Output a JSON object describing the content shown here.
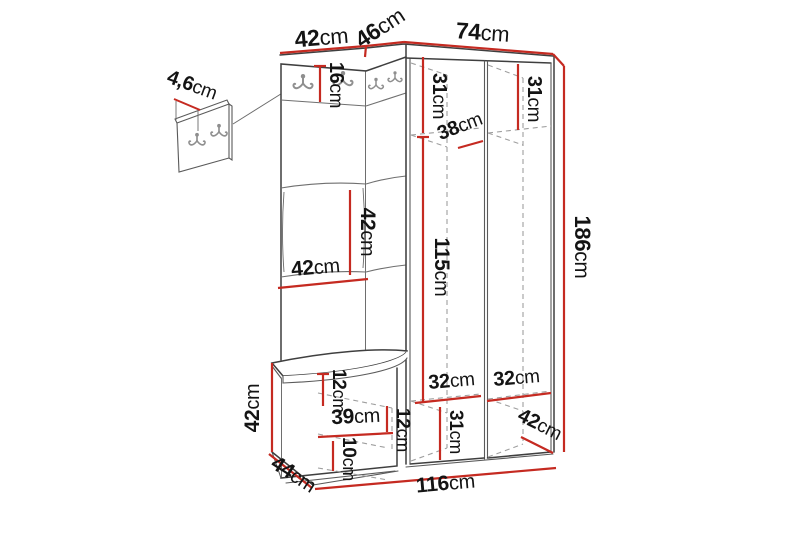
{
  "meta": {
    "description": "Technical dimension drawing of a corner hallway furniture set (coat panel, corner hook section, bench with shoe storage, open wardrobe) with a detail inset of the wall hook panel",
    "unit": "cm",
    "accent_red": "#c52a21",
    "line_color": "#3f3f3f",
    "dashed_color": "#9e9e9e",
    "background": "#ffffff"
  },
  "dims": {
    "detail_thickness": {
      "num": "4,6",
      "unit": "cm"
    },
    "top_left_width": {
      "num": "42",
      "unit": "cm"
    },
    "top_corner_width": {
      "num": "46",
      "unit": "cm"
    },
    "top_wardrobe_width": {
      "num": "74",
      "unit": "cm"
    },
    "hook_board_height": {
      "num": "16",
      "unit": "cm"
    },
    "upper_left_shelf_height": {
      "num": "31",
      "unit": "cm"
    },
    "upper_right_shelf_height": {
      "num": "31",
      "unit": "cm"
    },
    "upper_shelf_depth": {
      "num": "38",
      "unit": "cm"
    },
    "panel_section_height": {
      "num": "42",
      "unit": "cm"
    },
    "panel_width": {
      "num": "42",
      "unit": "cm"
    },
    "hanging_height": {
      "num": "115",
      "unit": "cm"
    },
    "total_height": {
      "num": "186",
      "unit": "cm"
    },
    "seat_thickness": {
      "num": "12",
      "unit": "cm"
    },
    "bench_height": {
      "num": "42",
      "unit": "cm"
    },
    "bench_inner_width": {
      "num": "39",
      "unit": "cm"
    },
    "bench_inner_height": {
      "num": "12",
      "unit": "cm"
    },
    "bench_drawer_height": {
      "num": "10",
      "unit": "cm"
    },
    "bench_depth": {
      "num": "44",
      "unit": "cm"
    },
    "lower_left_shelf_width": {
      "num": "32",
      "unit": "cm"
    },
    "lower_right_shelf_width": {
      "num": "32",
      "unit": "cm"
    },
    "lower_shelf_height": {
      "num": "31",
      "unit": "cm"
    },
    "wardrobe_depth": {
      "num": "42",
      "unit": "cm"
    },
    "total_width": {
      "num": "116",
      "unit": "cm"
    }
  }
}
